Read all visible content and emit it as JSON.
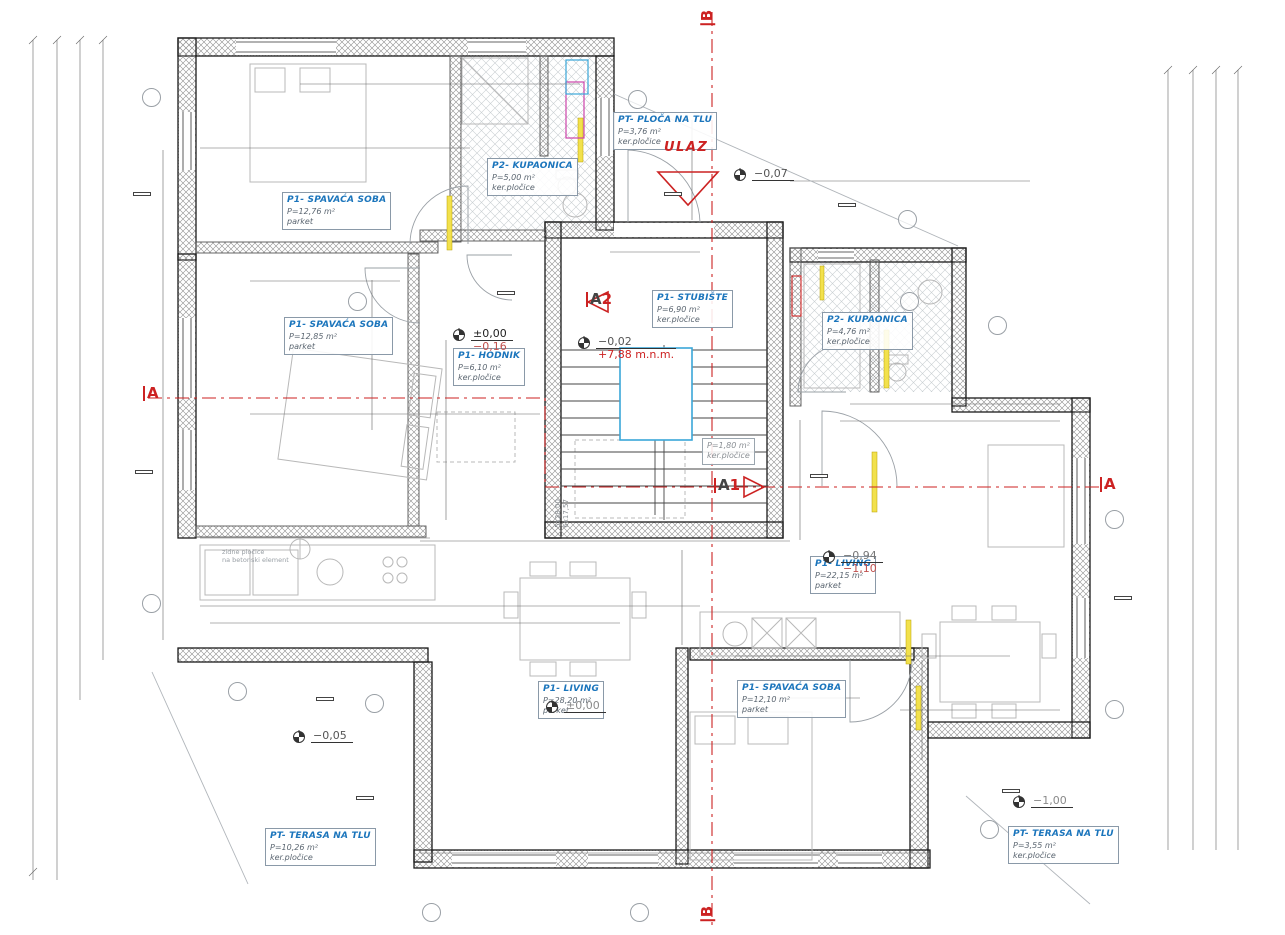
{
  "entrance": {
    "label": "ULAZ"
  },
  "stair_note": {
    "line1": "5x28,00",
    "line2": "6x17,57"
  },
  "plot_note": {
    "line1": "zidne pločice",
    "line2": "na betonski element"
  },
  "rooms": [
    {
      "name": "P1- SPAVAĆA SOBA",
      "area": "P=12,76 m²",
      "floor": "parket",
      "x": 282,
      "y": 192
    },
    {
      "name": "P2- KUPAONICA",
      "area": "P=5,00 m²",
      "floor": "ker.pločice",
      "x": 487,
      "y": 158
    },
    {
      "name": "PT- PLOČA NA TLU",
      "area": "P=3,76 m²",
      "floor": "ker.pločice",
      "x": 613,
      "y": 112
    },
    {
      "name": "P1- SPAVAĆA SOBA",
      "area": "P=12,85 m²",
      "floor": "parket",
      "x": 284,
      "y": 317
    },
    {
      "name": "P1- HODNIK",
      "area": "P=6,10 m²",
      "floor": "ker.pločice",
      "x": 453,
      "y": 348
    },
    {
      "name": "P1- STUBIŠTE",
      "area": "P=6,90 m²",
      "floor": "ker.pločice",
      "x": 652,
      "y": 290
    },
    {
      "name": "P2- KUPAONICA",
      "area": "P=4,76 m²",
      "floor": "ker.pločice",
      "x": 822,
      "y": 312
    },
    {
      "name": "P1- LIVING",
      "area": "P=22,15 m²",
      "floor": "parket",
      "x": 810,
      "y": 556
    },
    {
      "name": "P1- LIVING",
      "area": "P=28,20 m²",
      "floor": "parket",
      "x": 538,
      "y": 681
    },
    {
      "name": "P1- SPAVAĆA SOBA",
      "area": "P=12,10 m²",
      "floor": "parket",
      "x": 737,
      "y": 680
    },
    {
      "name": "PT- TERASA NA TLU",
      "area": "P=10,26 m²",
      "floor": "ker.pločice",
      "x": 265,
      "y": 828
    },
    {
      "name": "PT- TERASA NA TLU",
      "area": "P=3,55 m²",
      "floor": "ker.pločice",
      "x": 1008,
      "y": 826
    },
    {
      "name": "",
      "area": "P=1,80 m²",
      "floor": "ker.pločice",
      "x": 702,
      "y": 438,
      "cls": "small"
    }
  ],
  "elevations": [
    {
      "v1": "−0,07",
      "v2": "",
      "c1": "#555555",
      "c2": "#cc2222",
      "x": 733,
      "y": 168
    },
    {
      "v1": "±0,00",
      "v2": "−0,16",
      "c1": "#222222",
      "c2": "#c0504d",
      "x": 452,
      "y": 328
    },
    {
      "v1": "−0,02",
      "v2": "+7,88 m.n.m.",
      "c1": "#555555",
      "c2": "#cc2222",
      "x": 577,
      "y": 336
    },
    {
      "v1": "−0,94",
      "v2": "−1,10",
      "c1": "#777777",
      "c2": "#c0504d",
      "x": 822,
      "y": 550
    },
    {
      "v1": "±0,00",
      "v2": "",
      "c1": "#8a8a8a",
      "c2": "",
      "x": 545,
      "y": 700
    },
    {
      "v1": "−0,05",
      "v2": "",
      "c1": "#555555",
      "c2": "",
      "x": 292,
      "y": 730
    },
    {
      "v1": "−1,00",
      "v2": "",
      "c1": "#8a8a8a",
      "c2": "",
      "x": 1012,
      "y": 795
    }
  ],
  "sections": [
    {
      "t1": "B",
      "t2": "",
      "c1": "#cc2222",
      "x": 700,
      "y": 10,
      "r": -90
    },
    {
      "t1": "B",
      "t2": "",
      "c1": "#cc2222",
      "x": 700,
      "y": 906,
      "r": -90
    },
    {
      "t1": "A",
      "t2": "",
      "c1": "#cc2222",
      "x": 143,
      "y": 386,
      "r": 0
    },
    {
      "t1": "A",
      "t2": "",
      "c1": "#cc2222",
      "x": 1100,
      "y": 477,
      "r": 0
    },
    {
      "t1": "A",
      "t2": "1",
      "c1": "#444444",
      "x": 714,
      "y": 478,
      "r": 0
    },
    {
      "t1": "A",
      "t2": "2",
      "c1": "#444444",
      "x": 586,
      "y": 292,
      "r": 0
    }
  ],
  "tag_boxes": [
    {
      "t": "3",
      "x": 133,
      "y": 192
    },
    {
      "t": "3",
      "x": 135,
      "y": 470
    },
    {
      "t": "2",
      "x": 838,
      "y": 203
    },
    {
      "t": "3",
      "x": 1114,
      "y": 596
    },
    {
      "t": "4",
      "x": 356,
      "y": 796
    },
    {
      "t": "3",
      "x": 1002,
      "y": 789
    },
    {
      "t": "3",
      "x": 316,
      "y": 697
    },
    {
      "t": "JV1",
      "x": 497,
      "y": 291
    },
    {
      "t": "JV1",
      "x": 810,
      "y": 474
    },
    {
      "t": "–",
      "x": 664,
      "y": 192
    }
  ],
  "tag_circles": [
    {
      "t": "Z1",
      "x": 142,
      "y": 88
    },
    {
      "t": "Z1",
      "x": 628,
      "y": 90
    },
    {
      "t": "Z1",
      "x": 898,
      "y": 210
    },
    {
      "t": "Z1",
      "x": 988,
      "y": 316
    },
    {
      "t": "Z1",
      "x": 1105,
      "y": 510
    },
    {
      "t": "Z1",
      "x": 1105,
      "y": 700
    },
    {
      "t": "Z1",
      "x": 142,
      "y": 594
    },
    {
      "t": "Z1",
      "x": 228,
      "y": 682
    },
    {
      "t": "Z1",
      "x": 365,
      "y": 694
    },
    {
      "t": "Z1",
      "x": 422,
      "y": 903
    },
    {
      "t": "Z1",
      "x": 630,
      "y": 903
    },
    {
      "t": "Z1",
      "x": 980,
      "y": 820
    },
    {
      "t": "2",
      "x": 348,
      "y": 292
    },
    {
      "t": "2",
      "x": 900,
      "y": 292
    }
  ],
  "dims": [
    {
      "v": "593",
      "x": 400,
      "y": 66
    },
    {
      "v": "418",
      "x": 332,
      "y": 84
    },
    {
      "v": "59",
      "x": 505,
      "y": 84
    },
    {
      "v": "106",
      "x": 553,
      "y": 84
    },
    {
      "v": "145",
      "x": 248,
      "y": 102,
      "r": -90
    },
    {
      "v": "305",
      "x": 332,
      "y": 148
    },
    {
      "v": "355",
      "x": 437,
      "y": 152,
      "r": -90
    },
    {
      "v": "90",
      "x": 466,
      "y": 208,
      "r": -90
    },
    {
      "v": "220",
      "x": 480,
      "y": 208,
      "r": -90
    },
    {
      "v": "90",
      "x": 500,
      "y": 198
    },
    {
      "v": "328",
      "x": 313,
      "y": 191
    },
    {
      "v": "155",
      "x": 163,
      "y": 196,
      "r": -90
    },
    {
      "v": "200",
      "x": 692,
      "y": 170,
      "r": -90
    },
    {
      "v": "28",
      "x": 800,
      "y": 181
    },
    {
      "v": "84",
      "x": 831,
      "y": 181
    },
    {
      "v": "54",
      "x": 862,
      "y": 181
    },
    {
      "v": "138",
      "x": 936,
      "y": 181
    },
    {
      "v": "54",
      "x": 1000,
      "y": 181
    },
    {
      "v": "260",
      "x": 656,
      "y": 250
    },
    {
      "v": "310",
      "x": 318,
      "y": 281
    },
    {
      "v": "220",
      "x": 366,
      "y": 300,
      "r": -90
    },
    {
      "v": "90",
      "x": 383,
      "y": 268,
      "r": -90
    },
    {
      "v": "970",
      "x": 372,
      "y": 350,
      "r": -90
    },
    {
      "v": "175",
      "x": 446,
      "y": 370,
      "r": -90
    },
    {
      "v": "310",
      "x": 315,
      "y": 418
    },
    {
      "v": "90",
      "x": 470,
      "y": 414
    },
    {
      "v": "40",
      "x": 518,
      "y": 406
    },
    {
      "v": "145",
      "x": 446,
      "y": 488,
      "r": -90
    },
    {
      "v": "155",
      "x": 163,
      "y": 476,
      "r": -90
    },
    {
      "v": "25",
      "x": 252,
      "y": 412,
      "r": -90
    },
    {
      "v": "385",
      "x": 650,
      "y": 390,
      "r": -90
    },
    {
      "v": "112",
      "x": 668,
      "y": 408
    },
    {
      "v": "18",
      "x": 610,
      "y": 408
    },
    {
      "v": "245",
      "x": 855,
      "y": 420
    },
    {
      "v": "85",
      "x": 888,
      "y": 404
    },
    {
      "v": "182",
      "x": 1006,
      "y": 404
    },
    {
      "v": "157",
      "x": 1006,
      "y": 421
    },
    {
      "v": "80",
      "x": 818,
      "y": 280
    },
    {
      "v": "80",
      "x": 846,
      "y": 280
    },
    {
      "v": "90",
      "x": 806,
      "y": 298,
      "r": -90
    },
    {
      "v": "195",
      "x": 848,
      "y": 336,
      "r": -90
    },
    {
      "v": "180",
      "x": 908,
      "y": 328,
      "r": -90
    },
    {
      "v": "100",
      "x": 738,
      "y": 470
    },
    {
      "v": "220",
      "x": 738,
      "y": 488
    },
    {
      "v": "100",
      "x": 800,
      "y": 438,
      "r": -90
    },
    {
      "v": "35",
      "x": 800,
      "y": 526,
      "r": -90
    },
    {
      "v": "320",
      "x": 312,
      "y": 538
    },
    {
      "v": "188",
      "x": 476,
      "y": 541
    },
    {
      "v": "207",
      "x": 602,
      "y": 541
    },
    {
      "v": "153",
      "x": 758,
      "y": 541
    },
    {
      "v": "427",
      "x": 932,
      "y": 546
    },
    {
      "v": "510",
      "x": 964,
      "y": 580,
      "r": -90
    },
    {
      "v": "580",
      "x": 842,
      "y": 606,
      "r": -90
    },
    {
      "v": "170",
      "x": 682,
      "y": 563,
      "r": -90
    },
    {
      "v": "55",
      "x": 694,
      "y": 590,
      "r": -90
    },
    {
      "v": "170",
      "x": 682,
      "y": 618,
      "r": -90
    },
    {
      "v": "715",
      "x": 442,
      "y": 606
    },
    {
      "v": "375",
      "x": 548,
      "y": 623
    },
    {
      "v": "103",
      "x": 238,
      "y": 620
    },
    {
      "v": "340",
      "x": 320,
      "y": 620
    },
    {
      "v": "235",
      "x": 760,
      "y": 658
    },
    {
      "v": "90",
      "x": 850,
      "y": 658
    },
    {
      "v": "325",
      "x": 793,
      "y": 698
    },
    {
      "v": "90",
      "x": 866,
      "y": 686,
      "r": -90
    },
    {
      "v": "220",
      "x": 880,
      "y": 686,
      "r": -90
    },
    {
      "v": "140",
      "x": 922,
      "y": 730,
      "r": -90
    },
    {
      "v": "130",
      "x": 936,
      "y": 686,
      "r": -90
    },
    {
      "v": "60",
      "x": 914,
      "y": 710
    },
    {
      "v": "25",
      "x": 940,
      "y": 710
    },
    {
      "v": "170",
      "x": 1010,
      "y": 710
    },
    {
      "v": "245",
      "x": 986,
      "y": 656
    },
    {
      "v": "525",
      "x": 646,
      "y": 700,
      "r": -90
    },
    {
      "v": "355",
      "x": 462,
      "y": 758,
      "r": -90
    },
    {
      "v": "160",
      "x": 518,
      "y": 853
    },
    {
      "v": "155",
      "x": 602,
      "y": 853
    },
    {
      "v": "160",
      "x": 740,
      "y": 853
    },
    {
      "v": "160",
      "x": 840,
      "y": 853
    },
    {
      "v": "65",
      "x": 908,
      "y": 853
    },
    {
      "v": "60",
      "x": 448,
      "y": 853
    },
    {
      "v": "955",
      "x": 30,
      "y": 345,
      "r": -90
    },
    {
      "v": "910",
      "x": 56,
      "y": 345,
      "r": -90
    },
    {
      "v": "165",
      "x": 80,
      "y": 95,
      "r": -90
    },
    {
      "v": "160",
      "x": 80,
      "y": 200,
      "r": -90
    },
    {
      "v": "265",
      "x": 80,
      "y": 333,
      "r": -90
    },
    {
      "v": "60",
      "x": 80,
      "y": 448,
      "r": -90
    },
    {
      "v": "335",
      "x": 80,
      "y": 565,
      "r": -90
    },
    {
      "v": "205",
      "x": 80,
      "y": 652,
      "r": -90
    },
    {
      "v": "330",
      "x": 33,
      "y": 768,
      "r": -90
    },
    {
      "v": "210",
      "x": 33,
      "y": 816,
      "r": -90
    },
    {
      "v": "745",
      "x": 56,
      "y": 760,
      "r": -90
    },
    {
      "v": "132",
      "x": 103,
      "y": 77,
      "r": -90
    },
    {
      "v": "45",
      "x": 103,
      "y": 133,
      "r": -90
    },
    {
      "v": "155",
      "x": 103,
      "y": 198,
      "r": -90
    },
    {
      "v": "270",
      "x": 103,
      "y": 330,
      "r": -90
    },
    {
      "v": "55",
      "x": 103,
      "y": 460,
      "r": -90
    },
    {
      "v": "160",
      "x": 103,
      "y": 512,
      "r": -90
    },
    {
      "v": "84",
      "x": 163,
      "y": 548,
      "r": -90
    },
    {
      "v": "133",
      "x": 163,
      "y": 617,
      "r": -90
    },
    {
      "v": "250",
      "x": 1178,
      "y": 133,
      "r": -90
    },
    {
      "v": "270",
      "x": 1203,
      "y": 130,
      "r": -90
    },
    {
      "v": "260",
      "x": 1225,
      "y": 128,
      "r": -90
    },
    {
      "v": "20",
      "x": 1178,
      "y": 222,
      "r": -90
    },
    {
      "v": "40",
      "x": 1178,
      "y": 236,
      "r": -90
    },
    {
      "v": "25",
      "x": 1178,
      "y": 260,
      "r": -90
    },
    {
      "v": "60",
      "x": 1203,
      "y": 234,
      "r": -90
    },
    {
      "v": "70",
      "x": 1225,
      "y": 233,
      "r": -90
    },
    {
      "v": "180",
      "x": 1178,
      "y": 322,
      "r": -90
    },
    {
      "v": "205",
      "x": 1203,
      "y": 322,
      "r": -90
    },
    {
      "v": "275",
      "x": 1225,
      "y": 295,
      "r": -90
    },
    {
      "v": "25",
      "x": 1178,
      "y": 393,
      "r": -90
    },
    {
      "v": "250",
      "x": 1200,
      "y": 458,
      "r": -90
    },
    {
      "v": "1330",
      "x": 1240,
      "y": 460,
      "r": -90
    },
    {
      "v": "73",
      "x": 1122,
      "y": 405,
      "r": -90
    },
    {
      "v": "189",
      "x": 1160,
      "y": 492,
      "r": -90
    },
    {
      "v": "250",
      "x": 1178,
      "y": 560,
      "r": -90
    },
    {
      "v": "510",
      "x": 1203,
      "y": 572,
      "r": -90
    },
    {
      "v": "560",
      "x": 1225,
      "y": 572,
      "r": -90
    },
    {
      "v": "160",
      "x": 1178,
      "y": 638,
      "r": -90
    },
    {
      "v": "34",
      "x": 1160,
      "y": 662,
      "r": -90
    },
    {
      "v": "128",
      "x": 1160,
      "y": 710,
      "r": -90
    },
    {
      "v": "215",
      "x": 1178,
      "y": 822,
      "r": -90
    },
    {
      "v": "215",
      "x": 1203,
      "y": 822,
      "r": -90
    },
    {
      "v": "210",
      "x": 502,
      "y": 14,
      "r": -90,
      "g": true
    },
    {
      "v": "220",
      "x": 514,
      "y": 14,
      "r": -90,
      "g": true
    },
    {
      "v": "210",
      "x": 412,
      "y": 798,
      "r": -90,
      "g": true
    },
    {
      "v": "220",
      "x": 424,
      "y": 798,
      "r": -90,
      "g": true
    },
    {
      "v": "160",
      "x": 323,
      "y": 870,
      "r": -90,
      "g": true
    },
    {
      "v": "220",
      "x": 335,
      "y": 870,
      "r": -90,
      "g": true
    },
    {
      "v": "160",
      "x": 524,
      "y": 872,
      "r": -90,
      "g": true
    },
    {
      "v": "220",
      "x": 536,
      "y": 872,
      "r": -90,
      "g": true
    },
    {
      "v": "190",
      "x": 921,
      "y": 810,
      "r": -90,
      "g": true
    },
    {
      "v": "1",
      "x": 575,
      "y": 352,
      "g": true
    },
    {
      "v": "2",
      "x": 575,
      "y": 369,
      "g": true
    },
    {
      "v": "3",
      "x": 575,
      "y": 386,
      "g": true
    },
    {
      "v": "4",
      "x": 575,
      "y": 403,
      "g": true
    },
    {
      "v": "5",
      "x": 575,
      "y": 420,
      "g": true
    }
  ]
}
